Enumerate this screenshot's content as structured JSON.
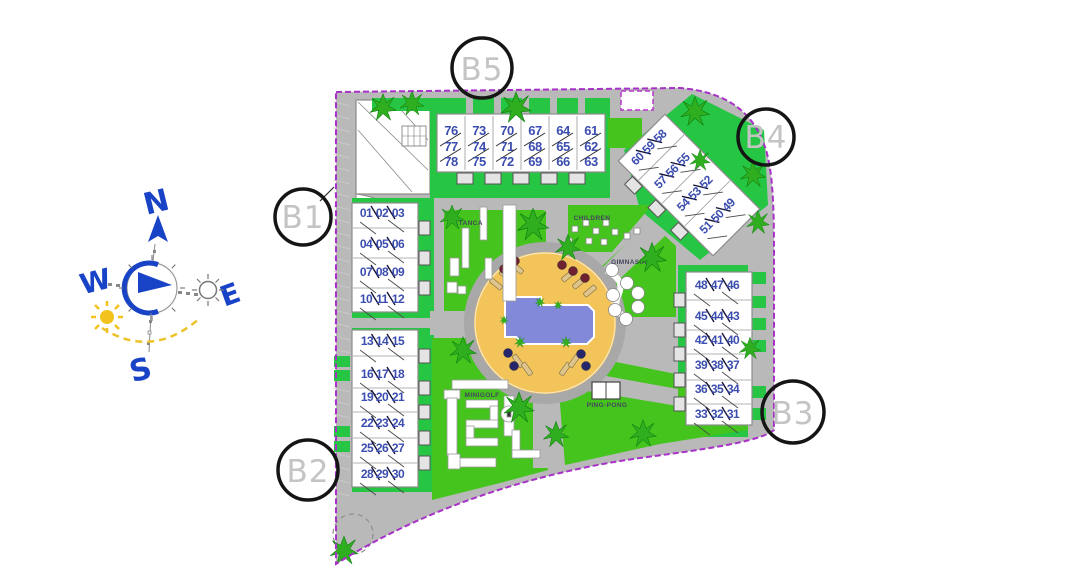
{
  "compass": {
    "n": "N",
    "e": "E",
    "s": "S",
    "w": "W"
  },
  "block_markers": [
    {
      "id": "b1",
      "label": "B1"
    },
    {
      "id": "b2",
      "label": "B2"
    },
    {
      "id": "b3",
      "label": "B3"
    },
    {
      "id": "b4",
      "label": "B4"
    },
    {
      "id": "b5",
      "label": "B5"
    }
  ],
  "amenity_labels": {
    "petanca": "PETANCA",
    "children": "CHILDREN",
    "gimnasia": "GIMNASIA",
    "minigolf": "MINIGOLF",
    "ping_pong": "PING-PONG"
  },
  "buildings": [
    {
      "id": "b5-terraces",
      "marker": "B5",
      "unit_rows": [
        [
          "76",
          "73",
          "70",
          "67",
          "64",
          "61"
        ],
        [
          "77",
          "74",
          "71",
          "68",
          "65",
          "62"
        ],
        [
          "78",
          "75",
          "72",
          "69",
          "66",
          "63"
        ]
      ]
    },
    {
      "id": "b4-terraces",
      "marker": "B4",
      "unit_rows": [
        [
          "60",
          "59",
          "58"
        ],
        [
          "57",
          "56",
          "55"
        ],
        [
          "54",
          "53",
          "52"
        ],
        [
          "51",
          "50",
          "49"
        ]
      ]
    },
    {
      "id": "b1-terraces",
      "marker": "B1",
      "unit_rows": [
        [
          "01",
          "02",
          "03"
        ],
        [
          "04",
          "05",
          "06"
        ],
        [
          "07",
          "08",
          "09"
        ],
        [
          "10",
          "11",
          "12"
        ]
      ]
    },
    {
      "id": "b2-terraces",
      "marker": "B2",
      "unit_rows": [
        [
          "13",
          "14",
          "15"
        ],
        [
          "16",
          "17",
          "18"
        ],
        [
          "19",
          "20",
          "21"
        ],
        [
          "22",
          "23",
          "24"
        ],
        [
          "25",
          "26",
          "27"
        ],
        [
          "28",
          "29",
          "30"
        ]
      ]
    },
    {
      "id": "b3-terraces",
      "marker": "B3",
      "unit_rows": [
        [
          "48",
          "47",
          "46"
        ],
        [
          "45",
          "44",
          "43"
        ],
        [
          "42",
          "41",
          "40"
        ],
        [
          "39",
          "38",
          "37"
        ],
        [
          "36",
          "35",
          "34"
        ],
        [
          "33",
          "32",
          "31"
        ]
      ]
    }
  ],
  "colors": {
    "boundary": "#a832c8",
    "road": "#b9b9b9",
    "lawn": "#44c41d",
    "parcel_green": "#27c544",
    "pool_water": "#8289d9",
    "pool_deck": "#f2c45a",
    "unit_number": "#3b4dae",
    "compass_blue": "#1843c6",
    "sun_yellow": "#f2c21d",
    "marker_text": "#c4c4c4",
    "tree_green": "#2fae1f"
  }
}
